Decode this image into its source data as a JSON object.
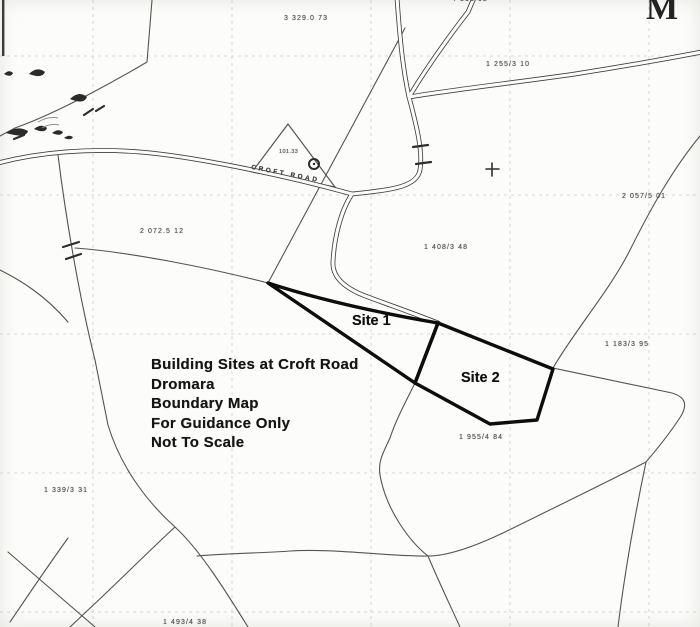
{
  "map": {
    "kind": "scanned boundary map",
    "corner_letter": "M",
    "road_label": "CROFT ROAD",
    "title_block": {
      "x": 151,
      "y": 356,
      "line_height": 19.5,
      "lines": [
        "Building Sites at Croft Road",
        "Dromara",
        "Boundary Map",
        "For Guidance Only",
        "Not To Scale"
      ]
    },
    "site_labels": [
      {
        "text": "Site 1",
        "x": 352,
        "y": 313
      },
      {
        "text": "Site 2",
        "x": 461,
        "y": 370
      }
    ],
    "parcel_numbers": [
      {
        "text": "3 329.0 73",
        "x": 284,
        "y": 15
      },
      {
        "text": "4 331 92",
        "x": 452,
        "y": -4
      },
      {
        "text": "1 255/3 10",
        "x": 486,
        "y": 61
      },
      {
        "text": "2 057/5 01",
        "x": 622,
        "y": 193
      },
      {
        "text": "2 072.5 12",
        "x": 140,
        "y": 228
      },
      {
        "text": "1 408/3 48",
        "x": 424,
        "y": 244
      },
      {
        "text": "1 183/3 95",
        "x": 605,
        "y": 341
      },
      {
        "text": "1 955/4 84",
        "x": 459,
        "y": 434
      },
      {
        "text": "1 339/3 31",
        "x": 44,
        "y": 487
      },
      {
        "text": "1 493/4 38",
        "x": 163,
        "y": 619
      },
      {
        "text": "101.33",
        "x": 279,
        "y": 149,
        "tiny": true
      }
    ],
    "colors": {
      "paper": "#fcfcfa",
      "grid": "#aeb4bd",
      "thin_boundary": "#55544f",
      "road": "#3f3f3c",
      "site_outline": "#0d0d0d",
      "ink": "#151515"
    }
  }
}
